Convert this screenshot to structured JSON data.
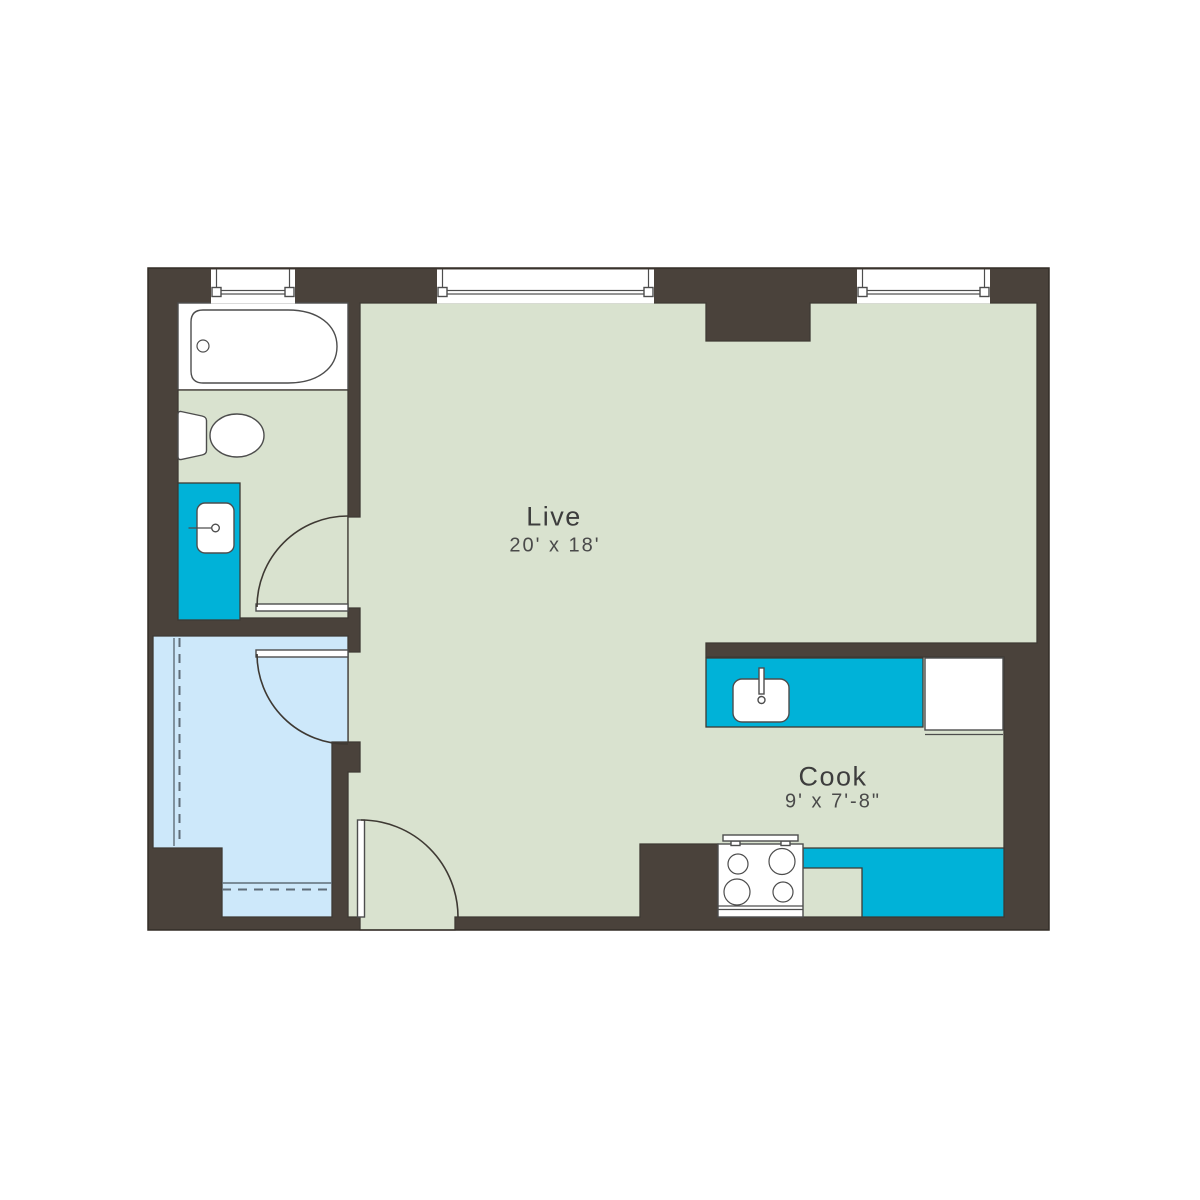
{
  "plan": {
    "rooms": [
      {
        "id": "live",
        "name": "Live",
        "dimensions": "20' x 18'"
      },
      {
        "id": "cook",
        "name": "Cook",
        "dimensions": "9' x 7'-8\""
      }
    ],
    "fixtures": [
      "bathtub",
      "toilet",
      "vanity-sink",
      "closet-rod-shelf",
      "kitchen-sink",
      "kitchen-counter",
      "refrigerator",
      "stove-cooktop",
      "bathroom-door",
      "closet-door",
      "entry-door",
      "window-bathroom",
      "window-live-left",
      "window-live-right"
    ],
    "colors": {
      "wall": "#4a423b",
      "floor": "#d9e2cf",
      "closet": "#cde8fa",
      "counter": "#00b2d8",
      "fixture": "#ffffff",
      "edge": "#3e3933",
      "line": "#4d4d4d",
      "rod": "#5f6d78",
      "outline": "#332d27",
      "text": "#3d3d3d",
      "text_dim": "#4a4a4a"
    }
  }
}
